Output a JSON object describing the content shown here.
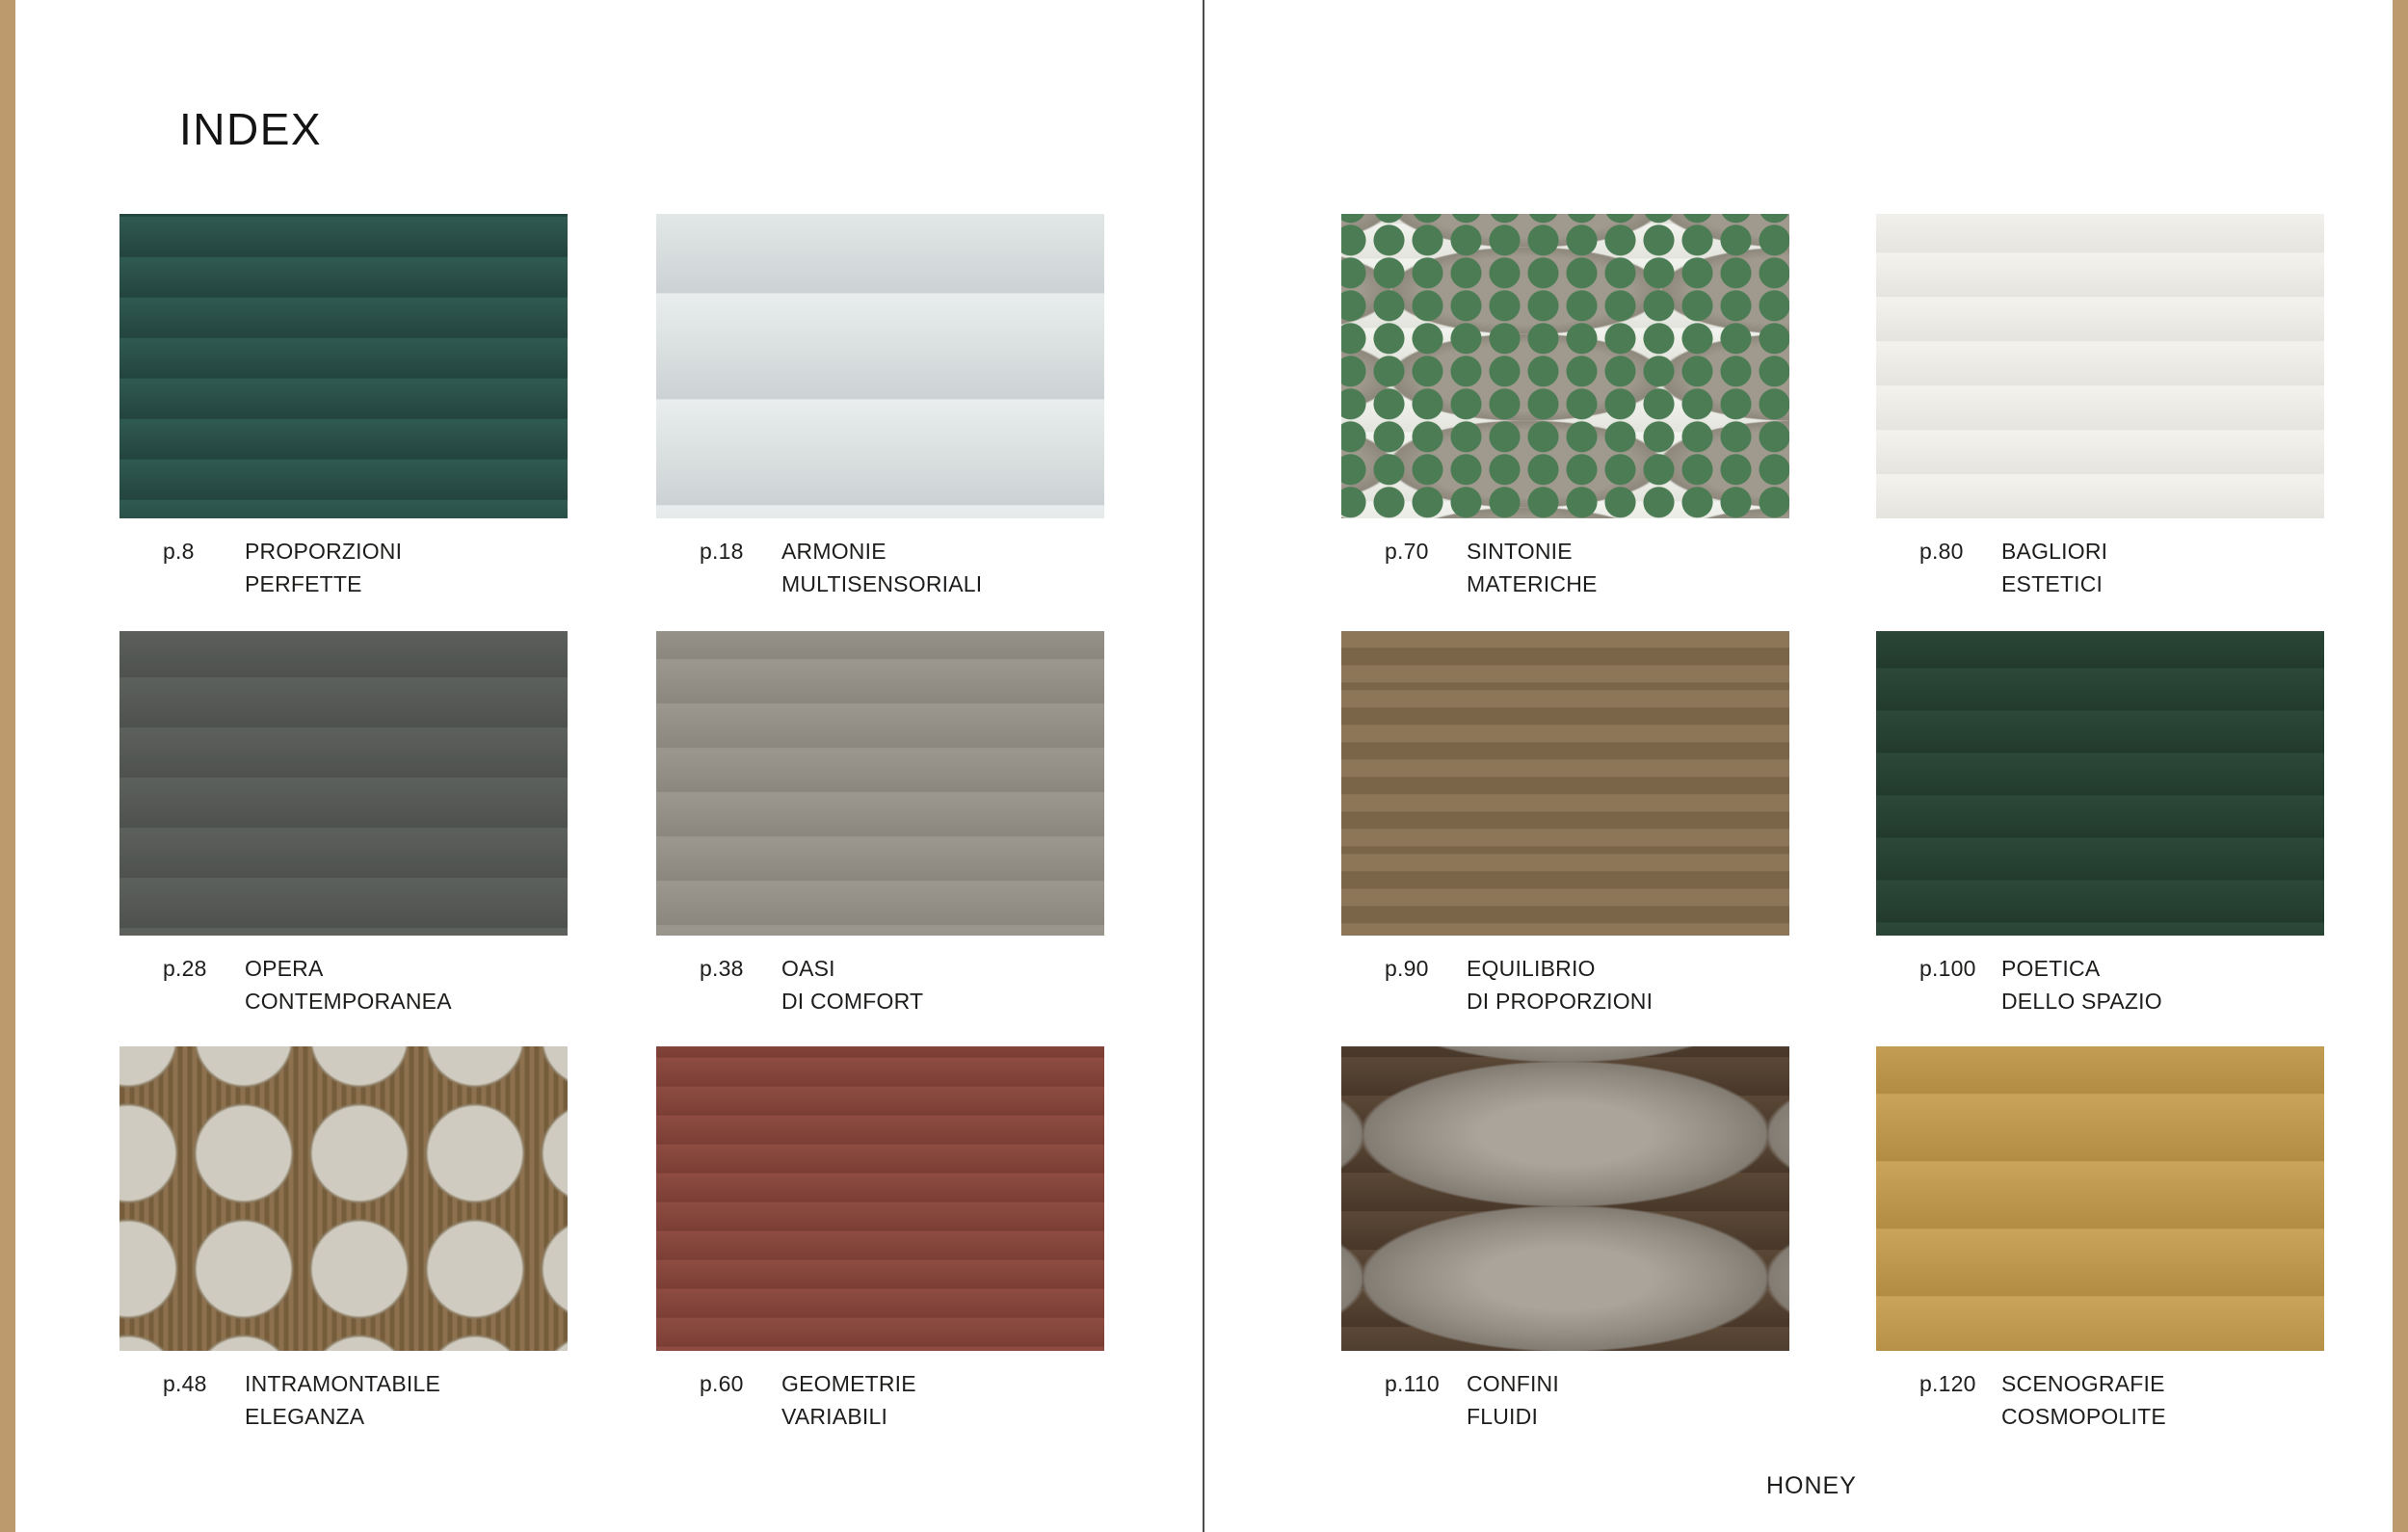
{
  "page": {
    "title": "INDEX",
    "brand": "HONEY"
  },
  "theme": {
    "accent": "#bd9a6e",
    "divider": "#4b4b4b",
    "text": "#1d1d1b",
    "background": "#ffffff"
  },
  "index": {
    "left": [
      {
        "page": "p.8",
        "title_line1": "PROPORZIONI",
        "title_line2": "PERFETTE",
        "image": "bedroom-suite-double-vanity-mirror-teal-stool"
      },
      {
        "page": "p.18",
        "title_line1": "ARMONIE",
        "title_line2": "MULTISENSORIALI",
        "image": "dark-marble-wall-twin-backlit-mirrors-black-chair"
      },
      {
        "page": "p.28",
        "title_line1": "OPERA",
        "title_line2": "CONTEMPORANEA",
        "image": "cream-room-green-curtains-sage-cabinet-arch"
      },
      {
        "page": "p.38",
        "title_line1": "OASI",
        "title_line2": "DI COMFORT",
        "image": "twin-navy-vanities-white-tub-large-window"
      },
      {
        "page": "p.48",
        "title_line1": "INTRAMONTABILE",
        "title_line2": "ELEGANZA",
        "image": "round-mirror-wood-slat-vanity-stone-wall"
      },
      {
        "page": "p.60",
        "title_line1": "GEOMETRIE",
        "title_line2": "VARIABILI",
        "image": "amber-marble-glass-cabinets-long-wood-vanity"
      }
    ],
    "right": [
      {
        "page": "p.70",
        "title_line1": "SINTONIE",
        "title_line2": "MATERICHE",
        "image": "floral-mural-ceiling-city-window-cloud-rug"
      },
      {
        "page": "p.80",
        "title_line1": "BAGLIORI",
        "title_line2": "ESTETICI",
        "image": "dark-panel-screens-round-mirror-garden-view"
      },
      {
        "page": "p.90",
        "title_line1": "EQUILIBRIO",
        "title_line2": "DI PROPORZIONI",
        "image": "streaked-walls-freestanding-tub-twin-columns"
      },
      {
        "page": "p.100",
        "title_line1": "POETICA",
        "title_line2": "DELLO SPAZIO",
        "image": "lounge-leather-armchairs-wide-mirror-green-rug"
      },
      {
        "page": "p.110",
        "title_line1": "CONFINI",
        "title_line2": "FLUIDI",
        "image": "white-room-chevron-floor-round-mirror-swirl-rug"
      },
      {
        "page": "p.120",
        "title_line1": "SCENOGRAFIE",
        "title_line2": "COSMOPOLITE",
        "image": "stone-corridor-white-vanity-city-window"
      }
    ]
  }
}
